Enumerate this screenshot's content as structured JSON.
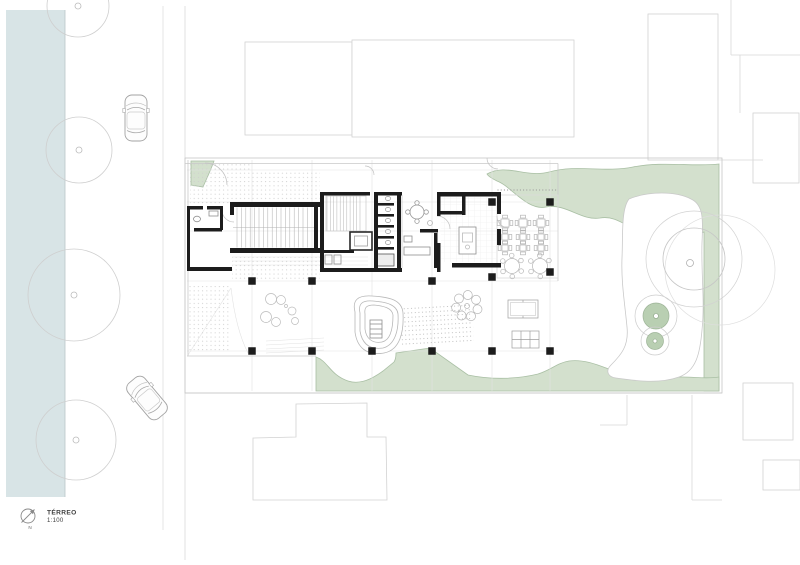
{
  "title_block": {
    "title": "TÉRREO",
    "scale": "1:100",
    "north_label": "N"
  },
  "colors": {
    "background": "#ffffff",
    "water": "#d8e4e6",
    "landscape": "#d3e0cd",
    "landscape_edge": "#a9bfa4",
    "tree_fill": "#b9cfb2",
    "walls": "#1c1c1c",
    "line_faint": "#dadada",
    "line_medium": "#9c9c9c"
  }
}
